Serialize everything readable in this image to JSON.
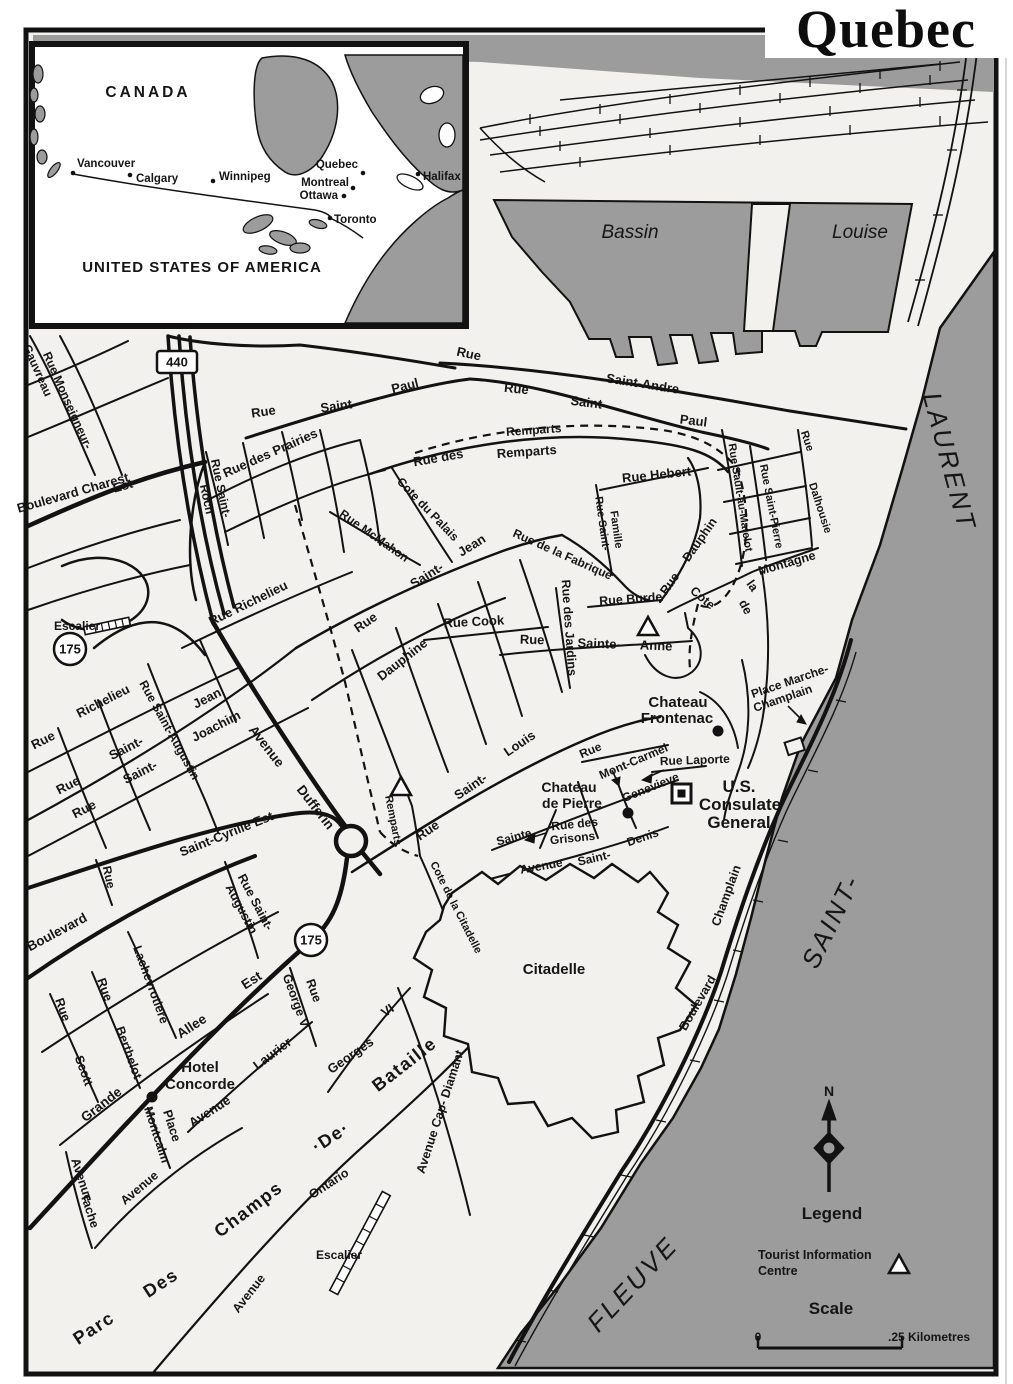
{
  "title": "Quebec",
  "inset": {
    "country_top": "CANADA",
    "country_bottom": "UNITED STATES OF AMERICA",
    "cities": [
      {
        "name": "Vancouver",
        "lx": 77,
        "ly": 167,
        "dx": 73,
        "dy": 173,
        "a": "start"
      },
      {
        "name": "Calgary",
        "lx": 136,
        "ly": 182,
        "dx": 130,
        "dy": 175,
        "a": "start"
      },
      {
        "name": "Winnipeg",
        "lx": 219,
        "ly": 180,
        "dx": 213,
        "dy": 181,
        "a": "start"
      },
      {
        "name": "Quebec",
        "lx": 358,
        "ly": 168,
        "dx": 363,
        "dy": 173,
        "a": "end"
      },
      {
        "name": "Montreal",
        "lx": 349,
        "ly": 186,
        "dx": 353,
        "dy": 188,
        "a": "end"
      },
      {
        "name": "Ottawa",
        "lx": 338,
        "ly": 199,
        "dx": 344,
        "dy": 196,
        "a": "end"
      },
      {
        "name": "Toronto",
        "lx": 334,
        "ly": 223,
        "dx": 330,
        "dy": 218,
        "a": "start"
      },
      {
        "name": "Halifax",
        "lx": 423,
        "ly": 180,
        "dx": 418,
        "dy": 174,
        "a": "start"
      }
    ]
  },
  "labels": [
    {
      "t": "Rue Monseigneur-",
      "x": 64,
      "y": 402,
      "r": 66,
      "s": 12
    },
    {
      "t": "Gauvreau",
      "x": 34,
      "y": 372,
      "r": 66,
      "s": 12
    },
    {
      "t": "Boulevard Charest",
      "x": 74,
      "y": 497,
      "r": -16,
      "s": 13
    },
    {
      "t": "Est",
      "x": 124,
      "y": 490,
      "r": -16,
      "s": 13
    },
    {
      "t": "Rue Saint-",
      "x": 217,
      "y": 489,
      "r": 78,
      "s": 12
    },
    {
      "t": "Roch",
      "x": 203,
      "y": 500,
      "r": 78,
      "s": 12
    },
    {
      "t": "Rue des Prairies",
      "x": 272,
      "y": 457,
      "r": -24,
      "s": 13
    },
    {
      "t": "Rue",
      "x": 264,
      "y": 416,
      "r": -8,
      "s": 13
    },
    {
      "t": "Saint-",
      "x": 339,
      "y": 410,
      "r": -8,
      "s": 13
    },
    {
      "t": "Paul",
      "x": 406,
      "y": 390,
      "r": -14,
      "s": 13
    },
    {
      "t": "Rue",
      "x": 468,
      "y": 358,
      "r": 12,
      "s": 13
    },
    {
      "t": "Saint-Andre",
      "x": 642,
      "y": 388,
      "r": 9,
      "s": 13
    },
    {
      "t": "Rue",
      "x": 516,
      "y": 393,
      "r": 6,
      "s": 13
    },
    {
      "t": "Saint-",
      "x": 588,
      "y": 407,
      "r": 7,
      "s": 13
    },
    {
      "t": "Paul",
      "x": 693,
      "y": 425,
      "r": 7,
      "s": 13
    },
    {
      "t": "Remparts",
      "x": 534,
      "y": 434,
      "r": -4,
      "s": 12
    },
    {
      "t": "Rue des",
      "x": 439,
      "y": 462,
      "r": -10,
      "s": 13
    },
    {
      "t": "Remparts",
      "x": 527,
      "y": 456,
      "r": -4,
      "s": 13
    },
    {
      "t": "Rue Hebert",
      "x": 657,
      "y": 479,
      "r": -6,
      "s": 13
    },
    {
      "t": "Rue Sault-au-Matelot",
      "x": 737,
      "y": 498,
      "r": 81,
      "s": 11
    },
    {
      "t": "Rue Saint-Pierre",
      "x": 768,
      "y": 507,
      "r": 79,
      "s": 11
    },
    {
      "t": "Rue",
      "x": 804,
      "y": 442,
      "r": 72,
      "s": 11
    },
    {
      "t": "Dalhousie",
      "x": 817,
      "y": 509,
      "r": 72,
      "s": 11
    },
    {
      "t": "Cote du Palais",
      "x": 425,
      "y": 512,
      "r": 46,
      "s": 12
    },
    {
      "t": "Rue McMahon",
      "x": 372,
      "y": 539,
      "r": 35,
      "s": 12
    },
    {
      "t": "Saint-",
      "x": 429,
      "y": 579,
      "r": -32,
      "s": 13
    },
    {
      "t": "Jean",
      "x": 474,
      "y": 549,
      "r": -32,
      "s": 13
    },
    {
      "t": "Rue de la Fabrique",
      "x": 561,
      "y": 558,
      "r": 24,
      "s": 12
    },
    {
      "t": "Rue Saint-",
      "x": 599,
      "y": 524,
      "r": 82,
      "s": 11
    },
    {
      "t": "Famille",
      "x": 613,
      "y": 530,
      "r": 82,
      "s": 11
    },
    {
      "t": "Rue Burde",
      "x": 631,
      "y": 603,
      "r": -4,
      "s": 12.5
    },
    {
      "t": "Rue des Jardins",
      "x": 565,
      "y": 628,
      "r": 86,
      "s": 12.5
    },
    {
      "t": "Rue Cook",
      "x": 474,
      "y": 626,
      "r": -3,
      "s": 13
    },
    {
      "t": "Rue",
      "x": 532,
      "y": 644,
      "r": 2,
      "s": 13
    },
    {
      "t": "Sainte-",
      "x": 599,
      "y": 648,
      "r": 2,
      "s": 13
    },
    {
      "t": "Anne",
      "x": 656,
      "y": 650,
      "r": 2,
      "s": 13
    },
    {
      "t": "Rue",
      "x": 673,
      "y": 586,
      "r": -55,
      "s": 12.5
    },
    {
      "t": "Dauphin",
      "x": 703,
      "y": 542,
      "r": -55,
      "s": 12.5
    },
    {
      "t": "Cote",
      "x": 700,
      "y": 601,
      "r": 40,
      "s": 12.5
    },
    {
      "t": "de",
      "x": 742,
      "y": 609,
      "r": 62,
      "s": 12.5
    },
    {
      "t": "la",
      "x": 749,
      "y": 588,
      "r": 55,
      "s": 12.5
    },
    {
      "t": "Montagne",
      "x": 788,
      "y": 567,
      "r": -16,
      "s": 12.5
    },
    {
      "t": "Escalier",
      "x": 77,
      "y": 630,
      "s": 12
    },
    {
      "t": "Rue Richelieu",
      "x": 250,
      "y": 607,
      "r": -26,
      "s": 13
    },
    {
      "t": "Rue",
      "x": 45,
      "y": 744,
      "r": -27,
      "s": 13
    },
    {
      "t": "Richelieu",
      "x": 105,
      "y": 705,
      "r": -27,
      "s": 13
    },
    {
      "t": "Rue",
      "x": 70,
      "y": 789,
      "r": -27,
      "s": 13
    },
    {
      "t": "Saint-",
      "x": 128,
      "y": 752,
      "r": -27,
      "s": 13
    },
    {
      "t": "Jean",
      "x": 209,
      "y": 702,
      "r": -27,
      "s": 13
    },
    {
      "t": "Rue",
      "x": 86,
      "y": 813,
      "r": -27,
      "s": 13
    },
    {
      "t": "Saint-",
      "x": 142,
      "y": 776,
      "r": -27,
      "s": 13
    },
    {
      "t": "Joachim",
      "x": 218,
      "y": 730,
      "r": -27,
      "s": 13
    },
    {
      "t": "Rue Saint-Augustin",
      "x": 166,
      "y": 732,
      "r": 61,
      "s": 12
    },
    {
      "t": "Avenue",
      "x": 263,
      "y": 749,
      "r": 52,
      "s": 13.5
    },
    {
      "t": "Dufferin",
      "x": 312,
      "y": 810,
      "r": 52,
      "s": 13.5
    },
    {
      "t": "Saint-Cyrille Est",
      "x": 228,
      "y": 838,
      "r": -22,
      "s": 13
    },
    {
      "t": "Rue",
      "x": 368,
      "y": 626,
      "r": -34,
      "s": 13
    },
    {
      "t": "Dauphine",
      "x": 405,
      "y": 663,
      "r": -38,
      "s": 13
    },
    {
      "t": "Rue",
      "x": 430,
      "y": 834,
      "r": -34,
      "s": 13
    },
    {
      "t": "Saint-",
      "x": 473,
      "y": 790,
      "r": -34,
      "s": 13
    },
    {
      "t": "Louis",
      "x": 522,
      "y": 747,
      "r": -34,
      "s": 13
    },
    {
      "t": "Remparts",
      "x": 390,
      "y": 821,
      "r": 79,
      "s": 11
    },
    {
      "t": "Cote de la Citadelle",
      "x": 453,
      "y": 909,
      "r": 63,
      "s": 11
    },
    {
      "t": "Sainte",
      "x": 515,
      "y": 841,
      "r": -15,
      "s": 12
    },
    {
      "t": "Genevieve",
      "x": 652,
      "y": 791,
      "r": -22,
      "s": 12
    },
    {
      "t": "Rue des",
      "x": 575,
      "y": 828,
      "r": -6,
      "s": 12
    },
    {
      "t": "Grisons",
      "x": 573,
      "y": 842,
      "r": -6,
      "s": 12
    },
    {
      "t": "Avenue",
      "x": 542,
      "y": 870,
      "r": -10,
      "s": 12
    },
    {
      "t": "Saint-",
      "x": 595,
      "y": 862,
      "r": -13,
      "s": 12
    },
    {
      "t": "Denis",
      "x": 644,
      "y": 841,
      "r": -19,
      "s": 12
    },
    {
      "t": "Rue",
      "x": 592,
      "y": 754,
      "r": -23,
      "s": 12
    },
    {
      "t": "Mont-Carmel",
      "x": 635,
      "y": 765,
      "r": -23,
      "s": 12
    },
    {
      "t": "Rue Laporte",
      "x": 695,
      "y": 764,
      "r": -2,
      "s": 12
    },
    {
      "t": "Place Marche-",
      "x": 791,
      "y": 685,
      "r": -19,
      "s": 12
    },
    {
      "t": "Champlain",
      "x": 784,
      "y": 702,
      "r": -19,
      "s": 12
    },
    {
      "t": "Boulevard",
      "x": 701,
      "y": 1005,
      "r": -60,
      "s": 12.5
    },
    {
      "t": "Champlain",
      "x": 730,
      "y": 897,
      "r": -70,
      "s": 12.5
    },
    {
      "t": "Georges",
      "x": 353,
      "y": 1059,
      "r": -35,
      "s": 13
    },
    {
      "t": "VI",
      "x": 390,
      "y": 1014,
      "r": -35,
      "s": 13
    },
    {
      "t": "Bataille",
      "x": 408,
      "y": 1069,
      "r": -38,
      "s": 18,
      "c": "park"
    },
    {
      "t": "Avenue Cap- Diamant",
      "x": 444,
      "y": 1113,
      "r": -72,
      "s": 12.5
    },
    {
      "t": "Grande",
      "x": 104,
      "y": 1108,
      "r": -38,
      "s": 13.5
    },
    {
      "t": "Allee",
      "x": 194,
      "y": 1030,
      "r": -33,
      "s": 13.5
    },
    {
      "t": "Est",
      "x": 254,
      "y": 984,
      "r": -33,
      "s": 13.5
    },
    {
      "t": "Laurier",
      "x": 275,
      "y": 1057,
      "r": -37,
      "s": 13
    },
    {
      "t": "Avenue",
      "x": 212,
      "y": 1115,
      "r": -33,
      "s": 13
    },
    {
      "t": "Rue",
      "x": 310,
      "y": 992,
      "r": 70,
      "s": 12.5
    },
    {
      "t": "George V",
      "x": 292,
      "y": 1002,
      "r": 70,
      "s": 12.5
    },
    {
      "t": "Lachevrotiere",
      "x": 147,
      "y": 986,
      "r": 70,
      "s": 12.5
    },
    {
      "t": "Rue",
      "x": 101,
      "y": 991,
      "r": 70,
      "s": 12.5
    },
    {
      "t": "Berthelot",
      "x": 125,
      "y": 1054,
      "r": 70,
      "s": 12.5
    },
    {
      "t": "Rue",
      "x": 59,
      "y": 1011,
      "r": 70,
      "s": 12.5
    },
    {
      "t": "Scott",
      "x": 80,
      "y": 1072,
      "r": 70,
      "s": 12.5
    },
    {
      "t": "Boulevard",
      "x": 59,
      "y": 936,
      "r": -28,
      "s": 13.5
    },
    {
      "t": "Rue Saint-",
      "x": 252,
      "y": 904,
      "r": 62,
      "s": 12.5
    },
    {
      "t": "Augustin",
      "x": 238,
      "y": 911,
      "r": 62,
      "s": 12.5
    },
    {
      "t": "Place",
      "x": 168,
      "y": 1127,
      "r": 72,
      "s": 12.5
    },
    {
      "t": "Montcalm",
      "x": 153,
      "y": 1136,
      "r": 72,
      "s": 12.5
    },
    {
      "t": "Avenue",
      "x": 78,
      "y": 1181,
      "r": 72,
      "s": 12.5
    },
    {
      "t": "Tache",
      "x": 86,
      "y": 1212,
      "r": 72,
      "s": 12.5
    },
    {
      "t": "Avenue",
      "x": 142,
      "y": 1191,
      "r": -40,
      "s": 12.5
    },
    {
      "t": "Parc",
      "x": 97,
      "y": 1333,
      "r": -33,
      "s": 18,
      "c": "park"
    },
    {
      "t": "Des",
      "x": 164,
      "y": 1288,
      "r": -33,
      "s": 18,
      "c": "park"
    },
    {
      "t": "Champs",
      "x": 252,
      "y": 1214,
      "r": -37,
      "s": 18,
      "c": "park"
    },
    {
      "t": "·De·",
      "x": 334,
      "y": 1142,
      "r": -33,
      "s": 18,
      "c": "park"
    },
    {
      "t": "Avenue",
      "x": 252,
      "y": 1296,
      "r": -52,
      "s": 12.5
    },
    {
      "t": "Ontario",
      "x": 331,
      "y": 1187,
      "r": -33,
      "s": 12.5
    },
    {
      "t": "Escalier",
      "x": 339,
      "y": 1259,
      "s": 12
    },
    {
      "t": "Rue",
      "x": 105,
      "y": 878,
      "r": 78,
      "s": 12
    },
    {
      "t": "Chateau",
      "x": 678,
      "y": 707,
      "s": 15,
      "c": "poi",
      "n": "label-chateau-frontenac"
    },
    {
      "t": "Frontenac",
      "x": 677,
      "y": 723,
      "s": 15,
      "c": "poi",
      "n": "label-chateau-frontenac"
    },
    {
      "t": "Chateau",
      "x": 569,
      "y": 792,
      "s": 14,
      "c": "poi",
      "n": "label-chateau-de-pierre"
    },
    {
      "t": "de Pierre",
      "x": 572,
      "y": 808,
      "s": 14,
      "c": "poi",
      "n": "label-chateau-de-pierre"
    },
    {
      "t": "Hotel",
      "x": 200,
      "y": 1072,
      "s": 15,
      "c": "poi",
      "n": "label-hotel-concorde"
    },
    {
      "t": "Concorde",
      "x": 200,
      "y": 1089,
      "s": 15,
      "c": "poi",
      "n": "label-hotel-concorde"
    },
    {
      "t": "U.S.",
      "x": 739,
      "y": 792,
      "s": 17,
      "c": "poi",
      "n": "label-us-consulate-general"
    },
    {
      "t": "Consulate",
      "x": 740,
      "y": 810,
      "s": 17,
      "c": "poi",
      "n": "label-us-consulate-general"
    },
    {
      "t": "General",
      "x": 739,
      "y": 828,
      "s": 17,
      "c": "poi",
      "n": "label-us-consulate-general"
    },
    {
      "t": "Citadelle",
      "x": 554,
      "y": 974,
      "s": 15,
      "c": "poi",
      "n": "label-citadelle"
    },
    {
      "t": "Bassin",
      "x": 630,
      "y": 238,
      "s": 19,
      "c": "water",
      "n": "water-label-bassin"
    },
    {
      "t": "Louise",
      "x": 860,
      "y": 238,
      "s": 19,
      "c": "water",
      "n": "water-label-louise"
    },
    {
      "t": "LAURENT",
      "x": 941,
      "y": 464,
      "r": 75,
      "s": 26,
      "c": "river",
      "n": "water-label-laurent"
    },
    {
      "t": "SAINT-",
      "x": 839,
      "y": 925,
      "r": -64,
      "s": 26,
      "c": "river",
      "n": "water-label-saint"
    },
    {
      "t": "FLEUVE",
      "x": 639,
      "y": 1290,
      "r": -47,
      "s": 26,
      "c": "river",
      "n": "water-label-fleuve"
    }
  ],
  "markers": {
    "dots": [
      {
        "name": "poi-chateau-frontenac",
        "x": 718,
        "y": 731
      },
      {
        "name": "poi-chateau-de-pierre",
        "x": 628,
        "y": 813
      },
      {
        "name": "poi-hotel-concorde",
        "x": 152,
        "y": 1097
      }
    ],
    "squares": [
      {
        "name": "poi-us-consulate-general",
        "x": 672,
        "y": 784
      }
    ],
    "triangles": [
      {
        "name": "tourist-info-sainte-anne",
        "x": 648,
        "y": 628
      },
      {
        "name": "tourist-info-remparts",
        "x": 401,
        "y": 788
      },
      {
        "name": "legend-tourist-info-symbol",
        "x": 899,
        "y": 1266
      }
    ]
  },
  "shields": [
    {
      "kind": "pill",
      "label": "440",
      "x": 177,
      "y": 362
    },
    {
      "kind": "circle",
      "label": "175",
      "x": 70,
      "y": 649
    },
    {
      "kind": "circle",
      "label": "175",
      "x": 311,
      "y": 940
    }
  ],
  "legend": {
    "north": "N",
    "title": "Legend",
    "item_tourist": "Tourist Information",
    "item_tourist2": "Centre",
    "scale_title": "Scale",
    "scale_start": "0",
    "scale_end": ".25 Kilometres"
  }
}
